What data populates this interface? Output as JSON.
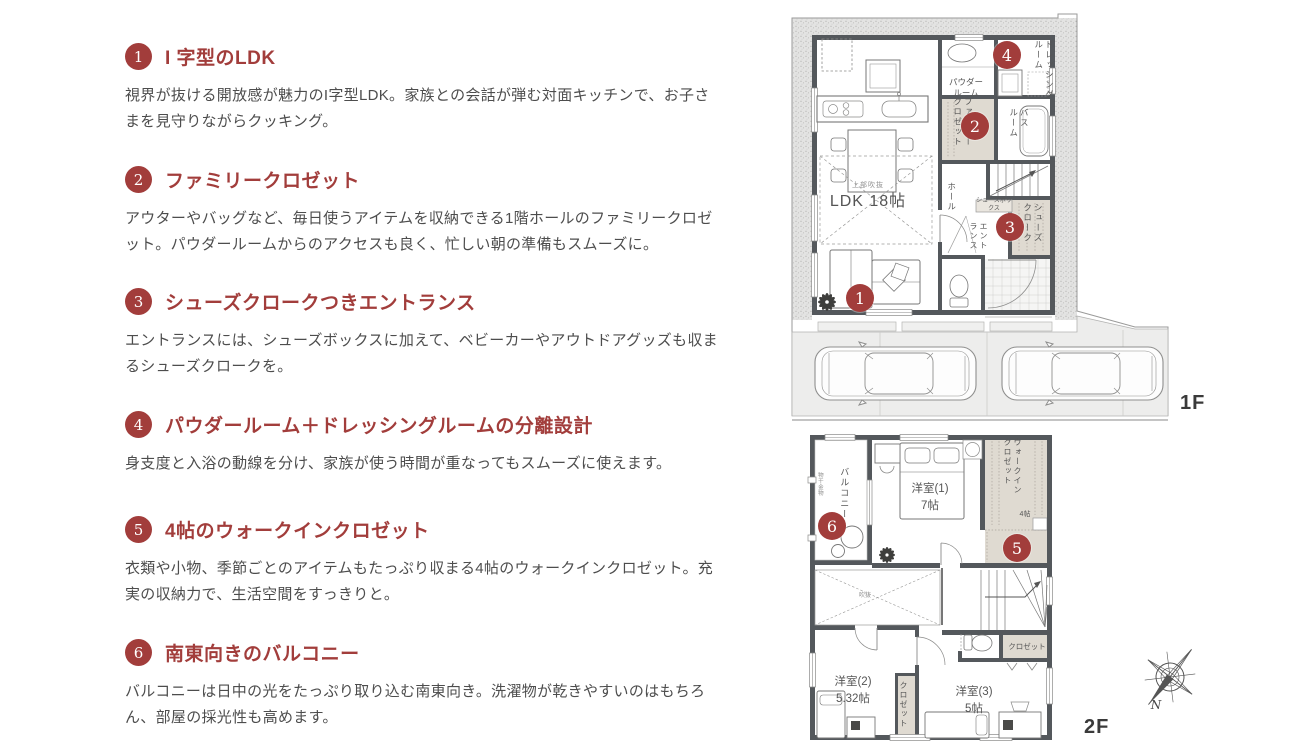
{
  "colors": {
    "accent": "#A23D3B",
    "body_text": "#4D4D4D",
    "plan_text": "#555555",
    "wall": "#54585C",
    "storage_fill": "#DFDAD1"
  },
  "features": [
    {
      "num": "1",
      "title": "I 字型のLDK",
      "desc": "視界が抜ける開放感が魅力のI字型LDK。家族との会話が弾む対面キッチンで、お子さまを見守りながらクッキング。"
    },
    {
      "num": "2",
      "title": "ファミリークロゼット",
      "desc": "アウターやバッグなど、毎日使うアイテムを収納できる1階ホールのファミリークロゼット。パウダールームからのアクセスも良く、忙しい朝の準備もスムーズに。"
    },
    {
      "num": "3",
      "title": "シューズクロークつきエントランス",
      "desc": "エントランスには、シューズボックスに加えて、ベビーカーやアウトドアグッズも収まるシューズクロークを。"
    },
    {
      "num": "4",
      "title": "パウダールーム＋ドレッシングルームの分離設計",
      "desc": "身支度と入浴の動線を分け、家族が使う時間が重なってもスムーズに使えます。"
    },
    {
      "num": "5",
      "title": "4帖のウォークインクロゼット",
      "desc": "衣類や小物、季節ごとのアイテムもたっぷり収まる4帖のウォークインクロゼット。充実の収納力で、生活空間をすっきりと。"
    },
    {
      "num": "6",
      "title": "南東向きのバルコニー",
      "desc": "バルコニーは日中の光をたっぷり取り込む南東向き。洗濯物が乾きやすいのはもちろん、部屋の採光性も高めます。"
    }
  ],
  "plan_1f": {
    "floor_label": "1F",
    "ldk_note": "上部吹抜",
    "ldk": "LDK 18帖",
    "powder_room": "パウダー\nルーム",
    "dressing_room": "ドレッシング\nルーム",
    "family_closet": "ファミリー\nクロゼット",
    "bath_room": "バス\nルーム",
    "hall": "ホール",
    "shoes_box": "シューズボックス",
    "entrance": "エント\nランス",
    "shoes_cloak": "シューズ\nクローク"
  },
  "plan_2f": {
    "floor_label": "2F",
    "balcony": "バルコニー",
    "laundry_hardware": "物干金物",
    "room1": "洋室(1)\n7帖",
    "walk_in_closet": "ウォークイン\nクロゼット",
    "wic_size": "4帖",
    "void_space": "吹抜",
    "closet_right": "クロゼット",
    "room2": "洋室(2)\n5.32帖",
    "closet_mid": "クロゼット",
    "room3": "洋室(3)\n5帖"
  },
  "markers": {
    "m1": "1",
    "m2": "2",
    "m3": "3",
    "m4": "4",
    "m5": "5",
    "m6": "6"
  },
  "compass": {
    "north_label": "N"
  }
}
